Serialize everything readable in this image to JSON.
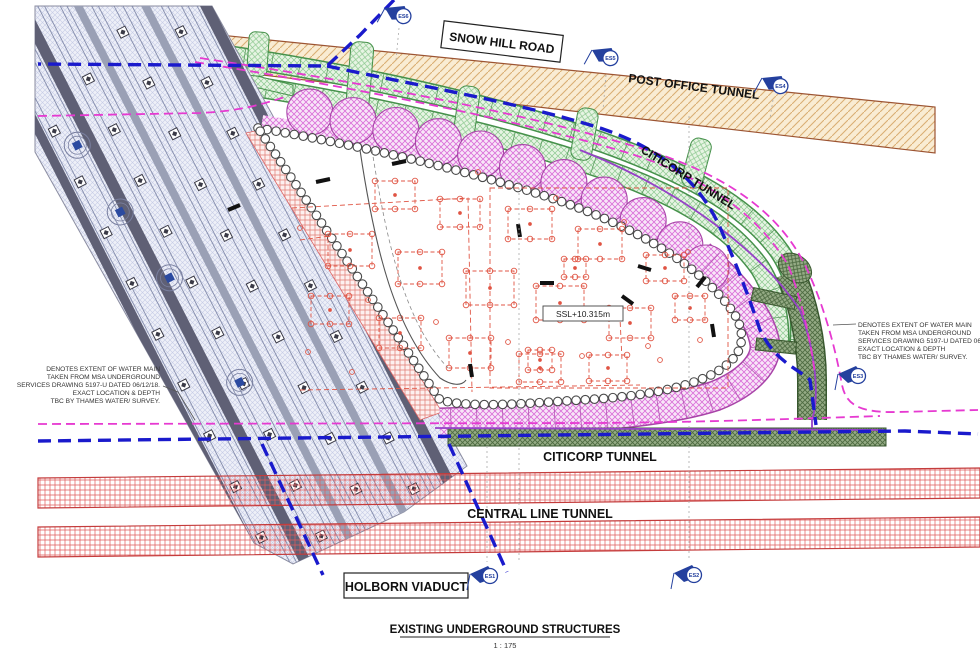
{
  "drawing": {
    "title": "EXISTING UNDERGROUND STRUCTURES",
    "scale": "1 : 175",
    "road_label": "SNOW HILL ROAD",
    "post_office_tunnel": "POST OFFICE TUNNEL",
    "citicorp_tunnel_upper": "CITICORP TUNNEL",
    "citicorp_tunnel_lower": "CITICORP TUNNEL",
    "central_line_tunnel": "CENTRAL LINE TUNNEL",
    "holborn_viaduct": "HOLBORN VIADUCT",
    "ssl_level": "SSL+10.315m",
    "water_main_note_left": [
      "DENOTES EXTENT OF WATER MAIN",
      "TAKEN FROM MSA UNDERGROUND",
      "SERVICES DRAWING 5197-U DATED 06/12/18.",
      "EXACT LOCATION & DEPTH",
      "TBC BY THAMES WATER/ SURVEY."
    ],
    "water_main_note_right": [
      "DENOTES EXTENT OF WATER MAIN",
      "TAKEN FROM MSA UNDERGROUND",
      "SERVICES DRAWING 5197-U DATED 06/12/18.",
      "EXACT LOCATION & DEPTH",
      "TBC BY THAMES WATER/ SURVEY."
    ],
    "survey_markers": [
      "ES1",
      "ES2",
      "ES3",
      "ES4",
      "ES5",
      "ES6"
    ],
    "colors": {
      "water_main_blue": "#1a1acc",
      "water_main_extent_magenta": "#e63ad1",
      "tunnel_axis_purple": "#9641c8",
      "post_office_tunnel_tan": "#f9ecd3",
      "citicorp_tunnel_green": "#e7f4e3",
      "citicorp_tunnel_olive": "#95ab85",
      "central_line_red": "#e05a5a",
      "viaduct_gray": "#5f6075",
      "pile_wall_pink": "#f8e6f8",
      "marker_blue": "#24409e"
    }
  }
}
